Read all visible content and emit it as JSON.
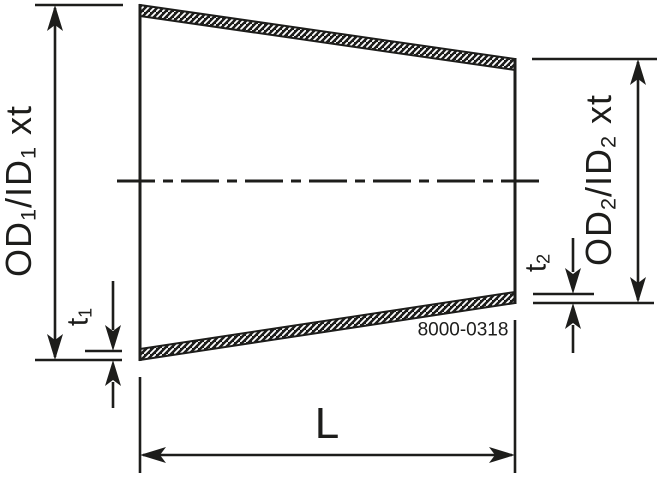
{
  "drawing": {
    "type": "technical-drawing-concentric-reducer",
    "part_number": "8000-0318",
    "colors": {
      "line": "#1d1d1b",
      "background": "#ffffff"
    },
    "labels": {
      "od1": {
        "part1": "OD",
        "sub1": "1",
        "part2": "/ID",
        "sub2": "1",
        "part3": " xt"
      },
      "od2": {
        "part1": "OD",
        "sub1": "2",
        "part2": "/ID",
        "sub2": "2",
        "part3": " xt"
      },
      "t1": {
        "part1": "t",
        "sub1": "1"
      },
      "t2": {
        "part1": "t",
        "sub1": "2"
      },
      "length": "L"
    }
  }
}
